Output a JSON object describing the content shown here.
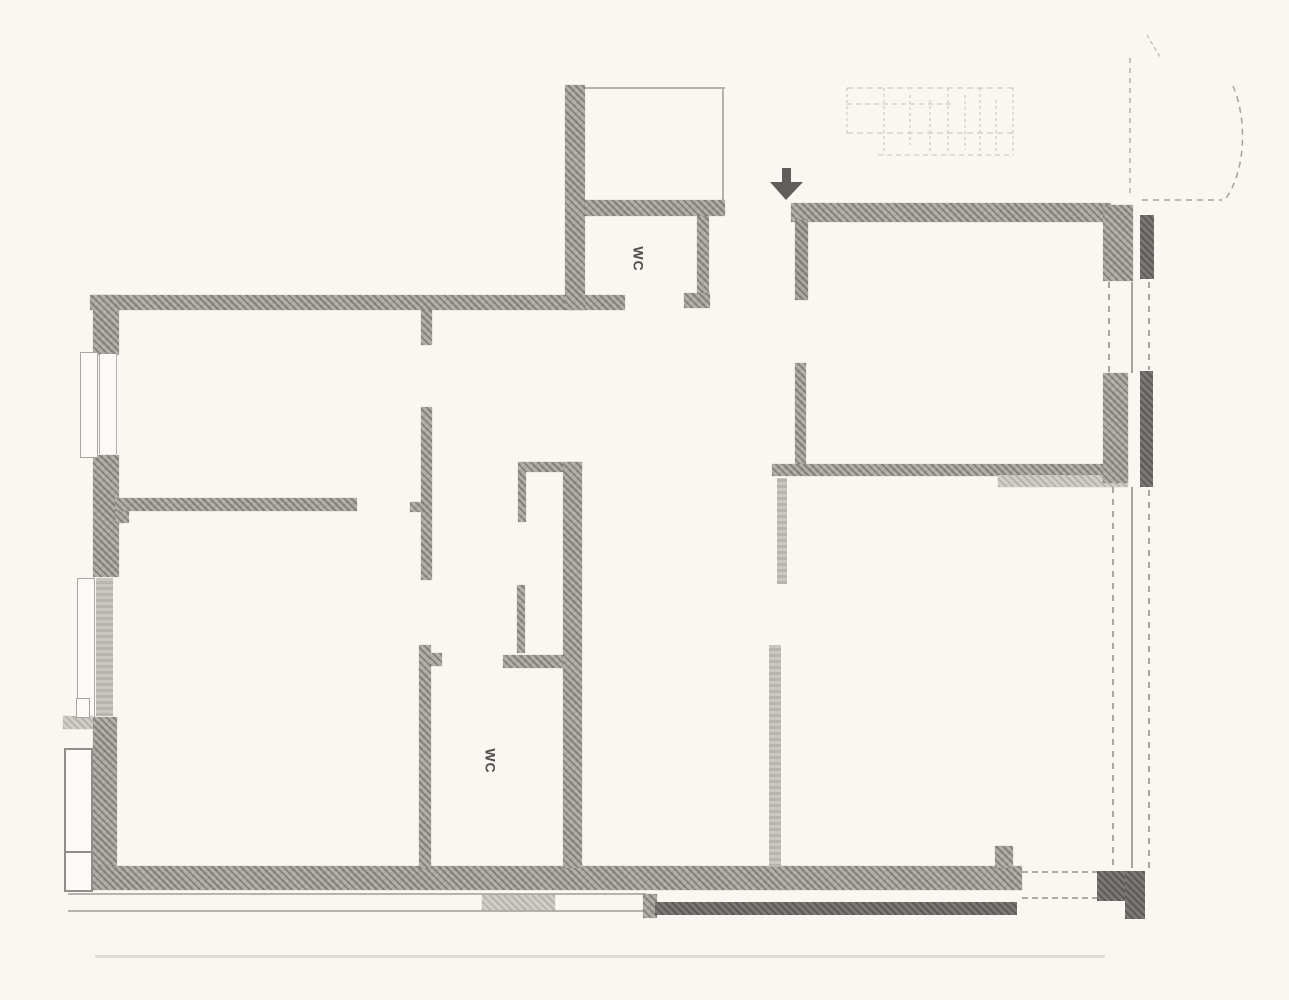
{
  "labels": {
    "wc_top": "WC",
    "wc_bottom": "WC"
  },
  "markers": {
    "entrance_arrow": "down-arrow"
  },
  "colors": {
    "paper": "#f8f7f2",
    "wall_hatch": "#aba9a3",
    "wall_dark": "#74726e",
    "faint_line": "#b5b3ad",
    "label_text": "#4f4d49"
  }
}
